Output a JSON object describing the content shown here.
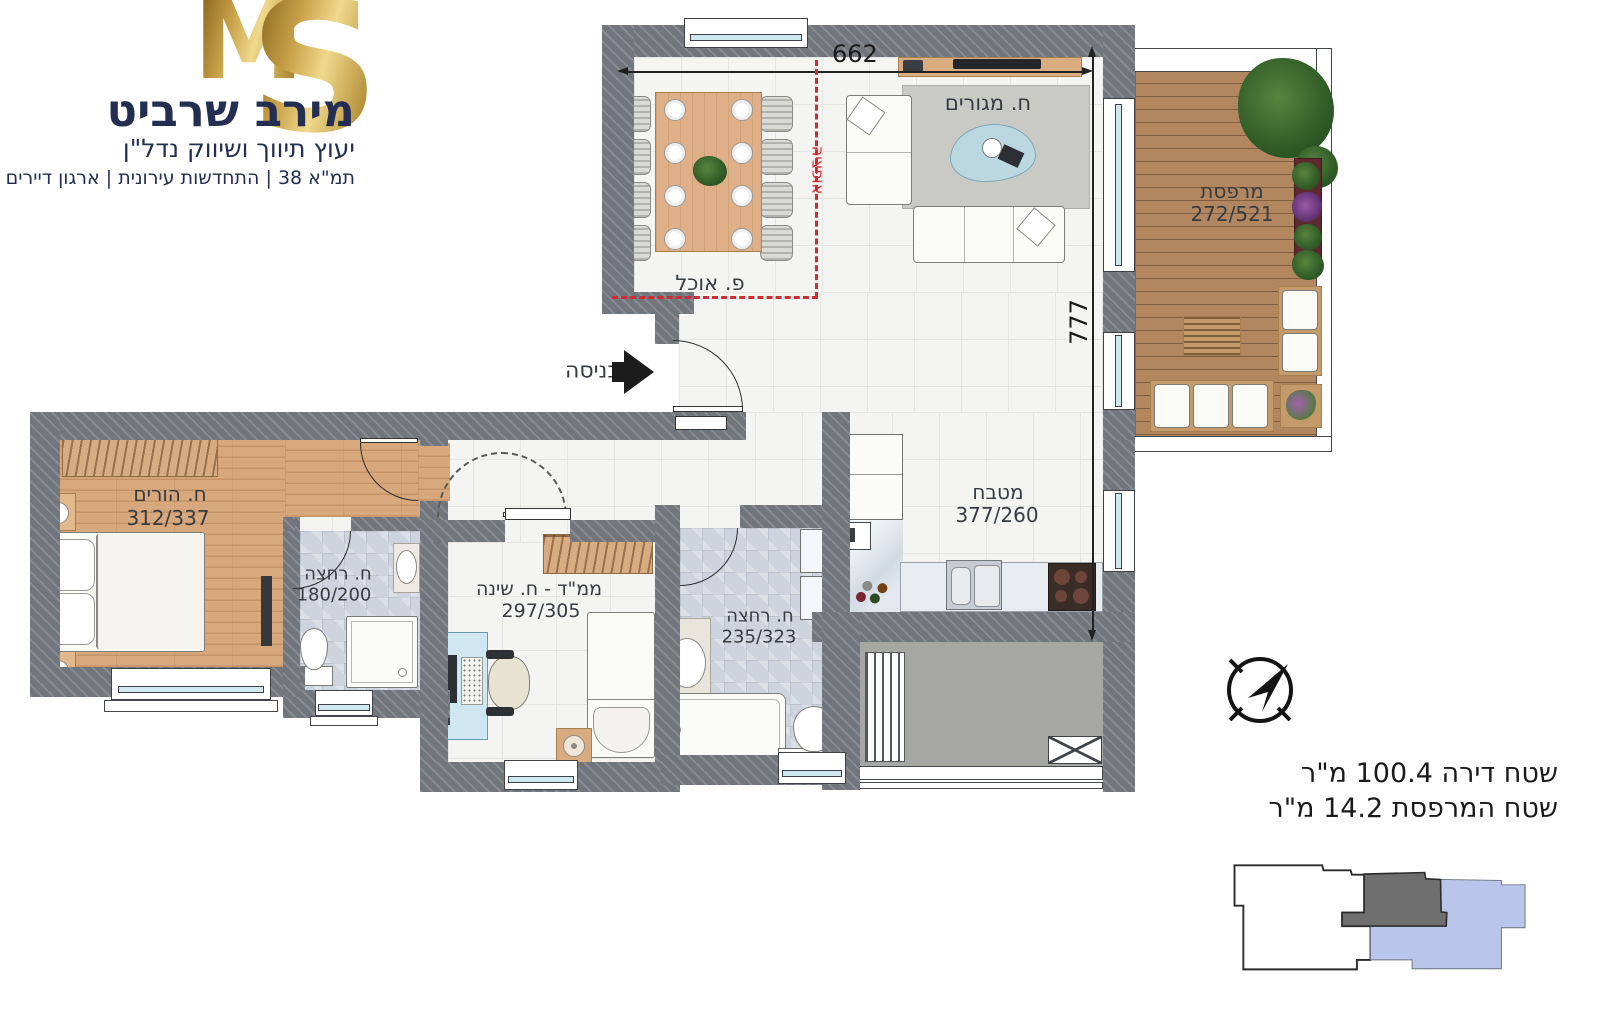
{
  "brand": {
    "logo_m": "M",
    "logo_s": "S",
    "name": "מירב שרביט",
    "tagline": "יעוץ תיווך ושיווק נדל\"ן",
    "services": "תמ\"א 38 | התחדשות עירונית | ארגון דיירים"
  },
  "rooms": {
    "dining": {
      "name": "פ. אוכל"
    },
    "living": {
      "name": "ח. מגורים"
    },
    "balcony": {
      "name": "מרפסת",
      "dims": "272/521"
    },
    "kitchen": {
      "name": "מטבח",
      "dims": "377/260"
    },
    "parents": {
      "name": "ח. הורים",
      "dims": "312/337"
    },
    "bath1": {
      "name": "ח. רחצה",
      "dims": "180/200"
    },
    "safe_bedroom": {
      "name": "ממ\"ד - ח. שינה",
      "dims": "297/305"
    },
    "bath2": {
      "name": "ח. רחצה",
      "dims": "235/323"
    },
    "entrance": {
      "name": "כניסה"
    },
    "option": {
      "name": "אופציה"
    }
  },
  "dimensions": {
    "width": "662",
    "height": "777"
  },
  "areas": {
    "apartment": "שטח דירה 100.4 מ\"ר",
    "balcony": "שטח המרפסת 14.2 מ\"ר"
  },
  "icons": {
    "compass": "compass-north-arrow",
    "entrance_arrow": "arrow-right"
  },
  "colors": {
    "wall_gray": "#71767d",
    "wood": "#d7a87c",
    "bath_tile": "#cdd4de",
    "option_red": "#cf2b32",
    "brand_gold": "#caa24a",
    "brand_navy": "#232e52",
    "minimap_selected": "#b9c6ea",
    "minimap_adjacent": "#6f6f6f"
  }
}
